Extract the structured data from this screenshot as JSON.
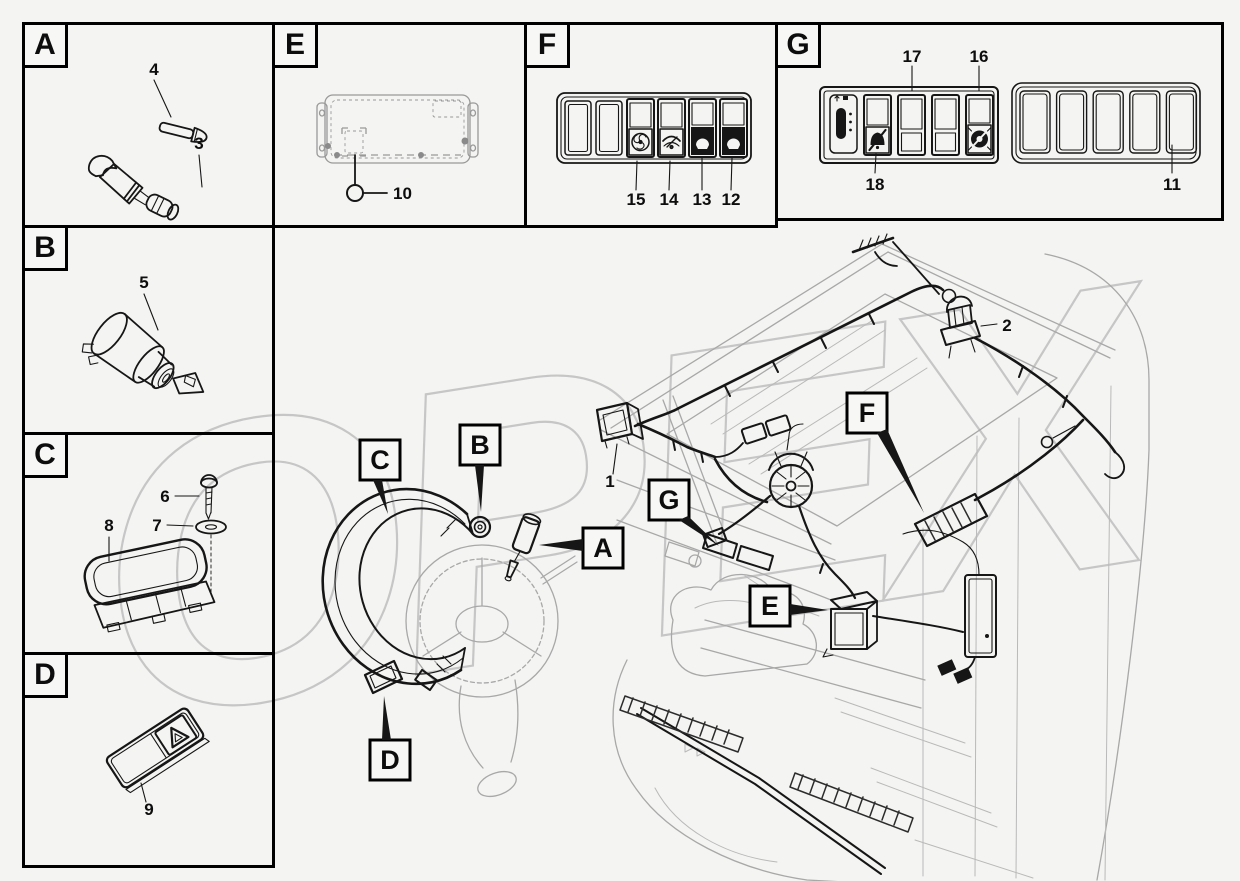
{
  "watermark": {
    "text": "OPEX",
    "color": "#c6c6c6"
  },
  "colors": {
    "line": "#161616",
    "cab_gray": "#a8a8a8",
    "background": "#f4f4f2"
  },
  "boxes": [
    {
      "id": "A",
      "label": "A",
      "parts": {
        "p4": "4",
        "p3": "3"
      },
      "items": [
        "bolt",
        "horn-plug-connector"
      ]
    },
    {
      "id": "B",
      "label": "B",
      "parts": {
        "p5": "5"
      },
      "items": [
        "ignition-switch-with-key"
      ]
    },
    {
      "id": "C",
      "label": "C",
      "parts": {
        "p6": "6",
        "p7": "7",
        "p8": "8"
      },
      "items": [
        "screw",
        "washer",
        "cab-dome-lamp"
      ]
    },
    {
      "id": "D",
      "label": "D",
      "parts": {
        "p9": "9"
      },
      "items": [
        "hazard-warning-switch"
      ]
    },
    {
      "id": "E",
      "label": "E",
      "parts": {
        "p10": "10"
      },
      "items": [
        "mounting-plate"
      ]
    },
    {
      "id": "F",
      "label": "F",
      "parts": {
        "p15": "15",
        "p14": "14",
        "p13": "13",
        "p12": "12"
      },
      "items": [
        "fan-switch",
        "wiper-switch",
        "front-work-lamp-switch",
        "rear-work-lamp-switch"
      ]
    },
    {
      "id": "G",
      "label": "G",
      "parts": {
        "p17": "17",
        "p16": "16",
        "p18": "18",
        "p11": "11"
      },
      "items": [
        "lever-module",
        "alarm-off-switch",
        "blank-switch",
        "beacon-switch",
        "blank-switch-panel"
      ]
    }
  ],
  "main": {
    "labels": {
      "A": "A",
      "B": "B",
      "C": "C",
      "D": "D",
      "E": "E",
      "F": "F",
      "G": "G"
    },
    "parts": {
      "p1": "1",
      "p2": "2"
    },
    "items": [
      "cab-line-drawing",
      "roof-wiring-harness",
      "front-lamp",
      "rotating-beacon",
      "steering-wheel",
      "steering-column-cover",
      "defroster-fan",
      "relay-box",
      "switch-panel",
      "side-control-box"
    ]
  },
  "icon_names": [
    "fan-icon",
    "wiper-icon",
    "work-lamp-icon",
    "work-lamp-icon",
    "lever-icon",
    "alarm-off-icon",
    "beacon-off-icon",
    "hazard-triangle-icon"
  ]
}
